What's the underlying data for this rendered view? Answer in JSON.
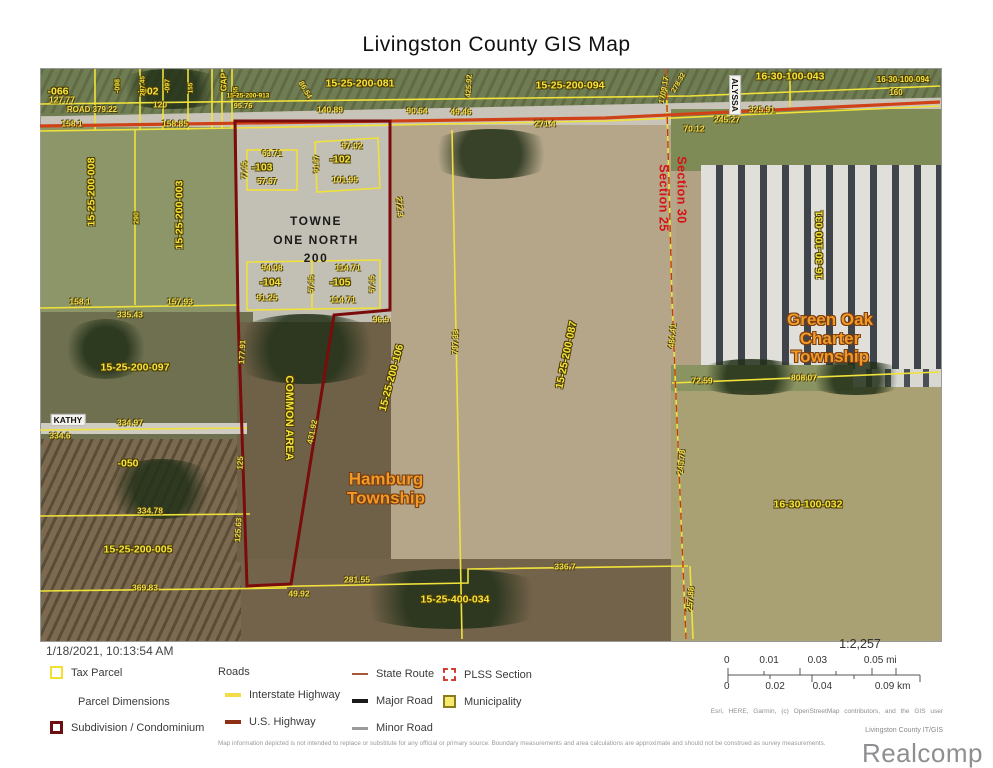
{
  "title": "Livingston County GIS Map",
  "timestamp": "1/18/2021, 10:13:54 AM",
  "colors": {
    "parcel_line": "#f0e23a",
    "dimension_text": "#f0dc4e",
    "subdivision_line": "#7a0c0c",
    "highway_line": "#cf4218",
    "section_text": "#d41414",
    "municipality_text": "#f09b28",
    "plss_dash": "#c23a10"
  },
  "map": {
    "site_label": {
      "text": "TOWNE\nONE NORTH\n200",
      "x": 316,
      "y": 240
    },
    "municipality_labels": [
      {
        "text": "Hamburg\nTownship",
        "x": 386,
        "y": 489
      },
      {
        "text": "Green Oak\nCharter\nTownship",
        "x": 830,
        "y": 339
      }
    ],
    "section_labels": [
      {
        "text": "Section 30",
        "x": 681,
        "y": 190,
        "r": 90
      },
      {
        "text": "Section 25",
        "x": 663,
        "y": 198,
        "r": 90
      }
    ],
    "road_labels": [
      {
        "text": "KATHY",
        "x": 68,
        "y": 420
      },
      {
        "text": "ALYSSA",
        "x": 735,
        "y": 95,
        "r": 90
      }
    ],
    "parcel_labels": [
      {
        "text": "-066",
        "x": 58,
        "y": 92
      },
      {
        "text": "-002",
        "x": 148,
        "y": 92
      },
      {
        "text": "-098",
        "x": 118,
        "y": 86,
        "r": -90,
        "fs": 7
      },
      {
        "text": "287.45",
        "x": 144,
        "y": 86,
        "r": -90,
        "fs": 6.5
      },
      {
        "text": "-097",
        "x": 168,
        "y": 86,
        "r": -90,
        "fs": 7
      },
      {
        "text": "155",
        "x": 192,
        "y": 88,
        "r": -90,
        "fs": 6.5
      },
      {
        "text": "GAP",
        "x": 224,
        "y": 82,
        "r": -90,
        "fs": 8.5
      },
      {
        "text": "155",
        "x": 237,
        "y": 92,
        "r": -90,
        "fs": 6.5
      },
      {
        "text": "15-25-200-913",
        "x": 248,
        "y": 97,
        "fs": 6.5
      },
      {
        "text": "15-25-200-081",
        "x": 360,
        "y": 84
      },
      {
        "text": "15-25-200-094",
        "x": 570,
        "y": 86
      },
      {
        "text": "16-30-100-043",
        "x": 790,
        "y": 77
      },
      {
        "text": "16-30-100-094",
        "x": 903,
        "y": 80,
        "fs": 8
      },
      {
        "text": "15-25-200-008",
        "x": 92,
        "y": 192,
        "r": -90
      },
      {
        "text": "290",
        "x": 137,
        "y": 218,
        "r": -90,
        "fs": 7
      },
      {
        "text": "15-25-200-003",
        "x": 180,
        "y": 215,
        "r": -90
      },
      {
        "text": "-102",
        "x": 340,
        "y": 160
      },
      {
        "text": "-103",
        "x": 262,
        "y": 168
      },
      {
        "text": "-104",
        "x": 270,
        "y": 283
      },
      {
        "text": "-105",
        "x": 340,
        "y": 283
      },
      {
        "text": "15-25-200-097",
        "x": 135,
        "y": 368
      },
      {
        "text": "-050",
        "x": 128,
        "y": 464
      },
      {
        "text": "15-25-200-005",
        "x": 138,
        "y": 550
      },
      {
        "text": "15-25-400-034",
        "x": 455,
        "y": 600
      },
      {
        "text": "COMMON AREA",
        "x": 288,
        "y": 418,
        "r": 90,
        "fs": 11
      },
      {
        "text": "15-25-200-106",
        "x": 392,
        "y": 378,
        "r": -75
      },
      {
        "text": "15-25-200-087",
        "x": 567,
        "y": 355,
        "r": -78
      },
      {
        "text": "16-30-100-031",
        "x": 820,
        "y": 245,
        "r": -90
      },
      {
        "text": "16-30-100-032",
        "x": 808,
        "y": 505
      }
    ],
    "dimension_labels": [
      {
        "text": "127.77",
        "x": 62,
        "y": 100
      },
      {
        "text": "ROAD 379.22",
        "x": 92,
        "y": 110,
        "fs": 8
      },
      {
        "text": "158.1",
        "x": 72,
        "y": 124
      },
      {
        "text": "120",
        "x": 160,
        "y": 105
      },
      {
        "text": "158.85",
        "x": 175,
        "y": 124
      },
      {
        "text": "95.76",
        "x": 243,
        "y": 106,
        "fs": 7.5
      },
      {
        "text": "86.54",
        "x": 305,
        "y": 90,
        "r": 60,
        "fs": 7.5
      },
      {
        "text": "140.89",
        "x": 330,
        "y": 110
      },
      {
        "text": "90.64",
        "x": 417,
        "y": 111
      },
      {
        "text": "49.46",
        "x": 461,
        "y": 112
      },
      {
        "text": "271.4",
        "x": 545,
        "y": 124
      },
      {
        "text": "425.92",
        "x": 469,
        "y": 86,
        "r": -87,
        "fs": 7.5
      },
      {
        "text": "1709.17",
        "x": 664,
        "y": 90,
        "r": -80,
        "fs": 7.5
      },
      {
        "text": "278.32",
        "x": 679,
        "y": 83,
        "r": -60,
        "fs": 7
      },
      {
        "text": "325.91",
        "x": 762,
        "y": 110
      },
      {
        "text": "245.27",
        "x": 727,
        "y": 120
      },
      {
        "text": "70.12",
        "x": 694,
        "y": 129
      },
      {
        "text": "160",
        "x": 896,
        "y": 93,
        "fs": 8
      },
      {
        "text": "63.71",
        "x": 272,
        "y": 154,
        "fs": 8
      },
      {
        "text": "77.05",
        "x": 245,
        "y": 170,
        "r": -90,
        "fs": 7
      },
      {
        "text": "57.67",
        "x": 267,
        "y": 182,
        "fs": 8
      },
      {
        "text": "97.02",
        "x": 352,
        "y": 146
      },
      {
        "text": "91.87",
        "x": 317,
        "y": 164,
        "r": -90,
        "fs": 7
      },
      {
        "text": "101.95",
        "x": 345,
        "y": 180
      },
      {
        "text": "272.3",
        "x": 399,
        "y": 207,
        "r": 85,
        "fs": 8
      },
      {
        "text": "94.08",
        "x": 272,
        "y": 268
      },
      {
        "text": "91.25",
        "x": 267,
        "y": 298
      },
      {
        "text": "114.71",
        "x": 348,
        "y": 268
      },
      {
        "text": "57.85",
        "x": 312,
        "y": 284,
        "r": -90,
        "fs": 7
      },
      {
        "text": "57.85",
        "x": 373,
        "y": 284,
        "r": -90,
        "fs": 7
      },
      {
        "text": "114.71",
        "x": 343,
        "y": 300
      },
      {
        "text": "96.9",
        "x": 381,
        "y": 320
      },
      {
        "text": "158.1",
        "x": 80,
        "y": 302
      },
      {
        "text": "157.93",
        "x": 180,
        "y": 302
      },
      {
        "text": "335.43",
        "x": 130,
        "y": 315
      },
      {
        "text": "177.91",
        "x": 243,
        "y": 352,
        "r": -87,
        "fs": 8
      },
      {
        "text": "334.97",
        "x": 130,
        "y": 423
      },
      {
        "text": "334.6",
        "x": 60,
        "y": 436
      },
      {
        "text": "431.92",
        "x": 313,
        "y": 432,
        "r": -78,
        "fs": 8
      },
      {
        "text": "125",
        "x": 241,
        "y": 463,
        "r": -87,
        "fs": 8
      },
      {
        "text": "334.78",
        "x": 150,
        "y": 511
      },
      {
        "text": "125.63",
        "x": 239,
        "y": 530,
        "r": -87,
        "fs": 8
      },
      {
        "text": "369.83",
        "x": 145,
        "y": 588
      },
      {
        "text": "49.92",
        "x": 299,
        "y": 594
      },
      {
        "text": "281.55",
        "x": 357,
        "y": 580
      },
      {
        "text": "336.7",
        "x": 565,
        "y": 567
      },
      {
        "text": "797.33",
        "x": 456,
        "y": 342,
        "r": -88,
        "fs": 8
      },
      {
        "text": "484.41",
        "x": 673,
        "y": 336,
        "r": -85,
        "fs": 8
      },
      {
        "text": "72.59",
        "x": 702,
        "y": 381
      },
      {
        "text": "808.07",
        "x": 804,
        "y": 378
      },
      {
        "text": "243.78",
        "x": 682,
        "y": 462,
        "r": -85,
        "fs": 8
      },
      {
        "text": "257.88",
        "x": 691,
        "y": 599,
        "r": -85,
        "fs": 8
      }
    ]
  },
  "legend": {
    "tax_parcel": "Tax Parcel",
    "parcel_dimensions": "Parcel Dimensions",
    "subdivision": "Subdivision / Condominium",
    "roads_header": "Roads",
    "interstate": "Interstate Highway",
    "us_highway": "U.S. Highway",
    "state_route": "State Route",
    "major_road": "Major Road",
    "minor_road": "Minor Road",
    "plss": "PLSS Section",
    "municipality": "Municipality"
  },
  "scale": {
    "ratio": "1:2,257",
    "mi_ticks": [
      "0",
      "0.01",
      "0.03",
      "0.05 mi"
    ],
    "km_ticks": [
      "0",
      "0.02",
      "0.04",
      "0.09 km"
    ]
  },
  "credits": {
    "attribution": "Esri, HERE, Garmin, (c) OpenStreetMap contributors, and the GIS user",
    "agency": "Livingston County IT/GIS",
    "disclaimer": "Map information depicted is not intended to replace or substitute for any official or primary source. Boundary measurements and area calculations are approximate and should not be construed as survey measurements.",
    "watermark": "Realcomp"
  }
}
